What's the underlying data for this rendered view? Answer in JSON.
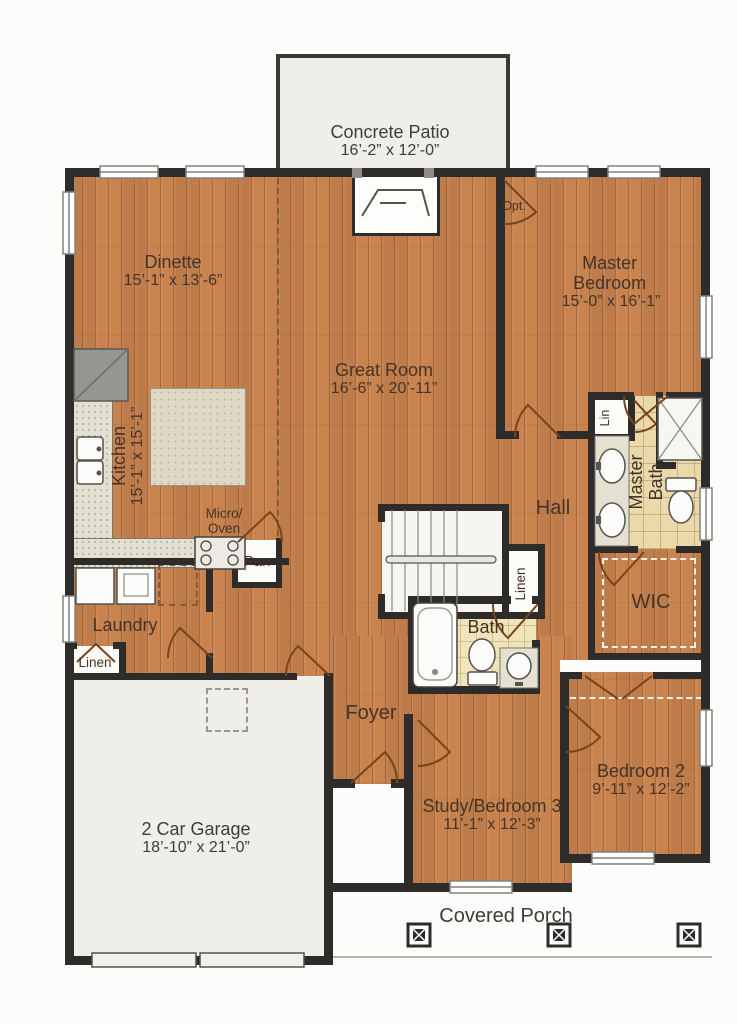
{
  "rooms": {
    "concrete_patio": {
      "name": "Concrete Patio",
      "dims": "16’-2” x 12’-0”"
    },
    "dinette": {
      "name": "Dinette",
      "dims": "15’-1” x 13’-6”"
    },
    "master_bedroom": {
      "name": "Master Bedroom",
      "dims": "15’-0” x 16’-1”"
    },
    "great_room": {
      "name": "Great Room",
      "dims": "16’-6” x 20’-11”"
    },
    "kitchen": {
      "name": "Kitchen",
      "dims": "15’-1” x 15’-1”"
    },
    "hall": {
      "name": "Hall"
    },
    "master_bath": {
      "name": "Master Bath"
    },
    "wic": {
      "name": "WIC"
    },
    "laundry": {
      "name": "Laundry"
    },
    "bath": {
      "name": "Bath"
    },
    "foyer": {
      "name": "Foyer"
    },
    "garage": {
      "name": "2 Car Garage",
      "dims": "18’-10” x 21’-0”"
    },
    "study_bedroom3": {
      "name": "Study/Bedroom 3",
      "dims": "11’-1” x 12’-3”"
    },
    "bedroom2": {
      "name": "Bedroom 2",
      "dims": "9’-11” x 12’-2”"
    },
    "covered_porch": {
      "name": "Covered Porch"
    }
  },
  "closets": {
    "pantry": "Pan",
    "linen_hall": "Linen",
    "linen_master": "Lin",
    "linen_laundry": "Linen"
  },
  "annotations": {
    "micro_oven_line1": "Micro/",
    "micro_oven_line2": "Oven",
    "optional_door": "Opt."
  },
  "colors": {
    "wood_floor": "#c8834e",
    "master_bath_tile": "#ead9ab",
    "hall_bath_tile": "#f0e4ba",
    "counter": "#e4e1d3",
    "island": "#ded8c4",
    "wall": "#2e2c2a",
    "door_swing": "#7a4418",
    "exterior_concrete": "#f0eee9"
  }
}
